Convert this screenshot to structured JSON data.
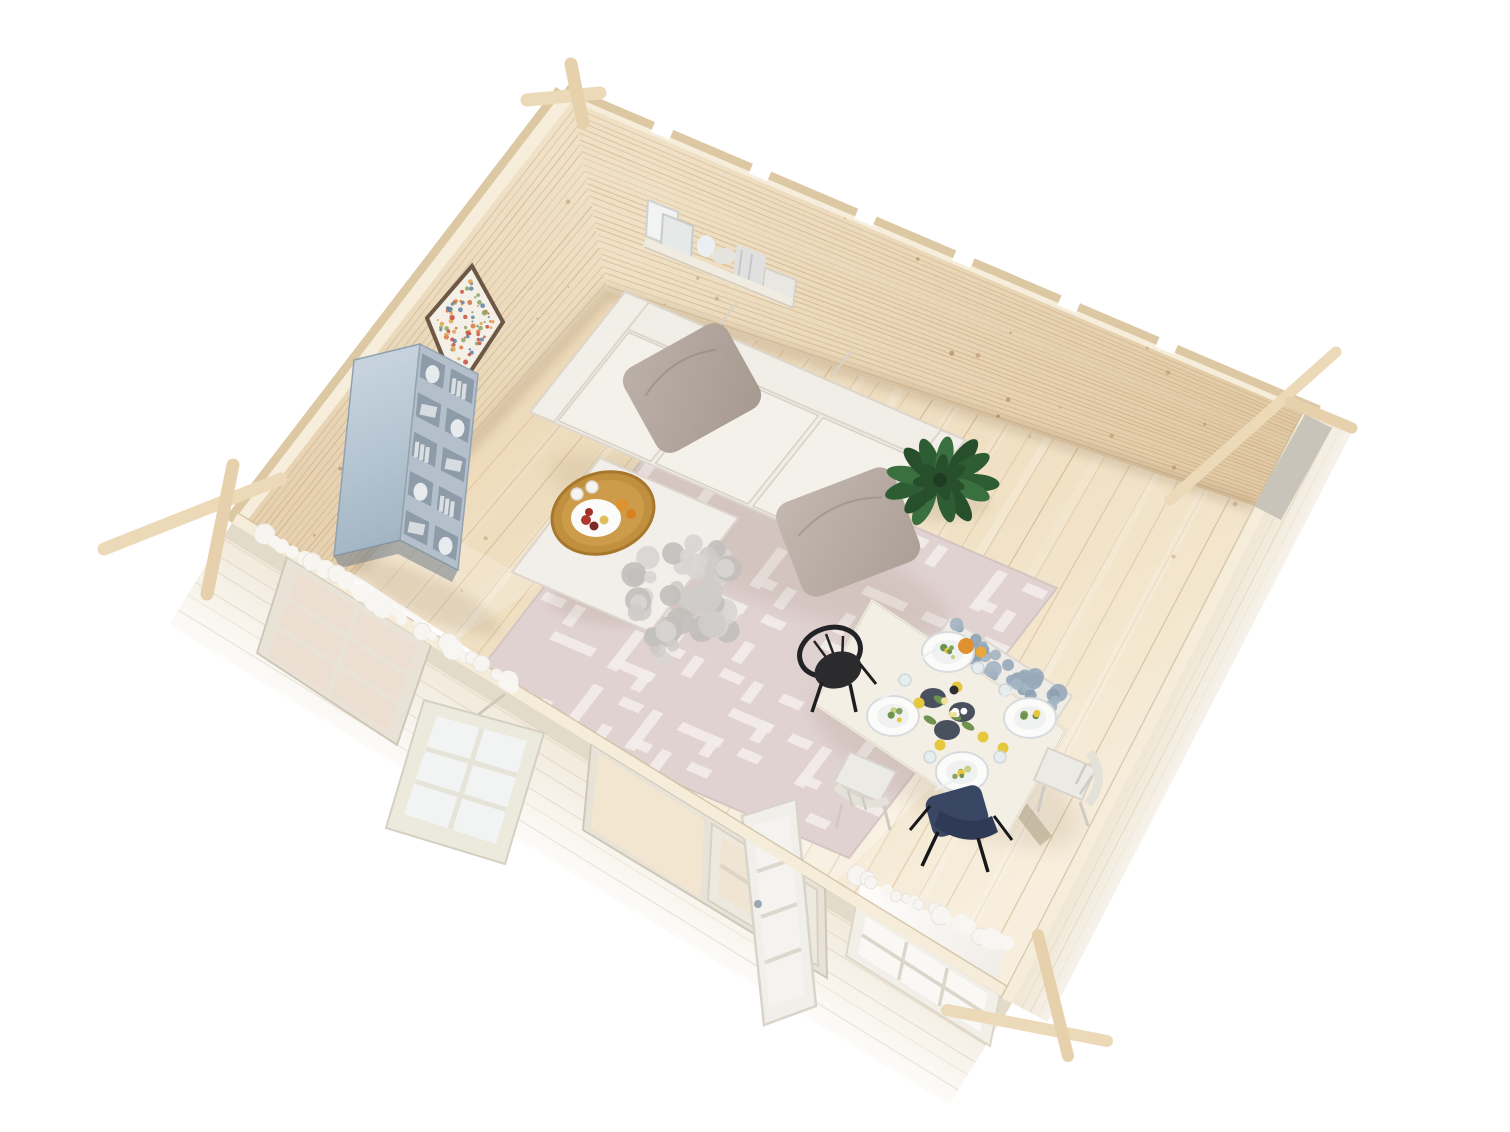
{
  "scene": {
    "description": "Aerial 3D render of a log cabin garden-room interior with lounge and dining furniture, no visible text",
    "background": "#ffffff"
  },
  "colors": {
    "wall_wood_light": "#f0e2c8",
    "wall_wood_shade": "#e2cda9",
    "wall_top": "#f6eedb",
    "wall_outer_edge": "#ddc8a4",
    "floor_light": "#f7eedd",
    "floor_warm": "#ecd9b8",
    "grain_line": "#b98c5c",
    "knot_brown": "#a97f4f",
    "front_wall_face": "#efe7d7",
    "ledge": "#f5ecd9",
    "molding": "#e3dbc9",
    "window_frame": "#e9e3d7",
    "window_glass_warm": "#ecdfd2",
    "window_glass_cool": "#f2f4f3",
    "door_glass": "#efe5d2",
    "doorway_interior": "#f2e6d1",
    "grid_bar": "#dcd6ca",
    "curtain_white": "#f9f8f5",
    "garland_white": "#f8f6f2",
    "rug_base": "#e0d2d1",
    "rug_pattern": "#f2ebea",
    "sofa_body": "#f0ece6",
    "sofa_cushion": "#f4f0ea",
    "sofa_seam": "#d9d2c8",
    "pillow_taupe": "#b3a79f",
    "pillow_taupe_dark": "#a5988f",
    "ottoman": "#f2eee9",
    "fur_tones": [
      "#cfccc9",
      "#c2bfbc",
      "#d8d5d2"
    ],
    "tray_gold": "#c0903f",
    "tray_rim": "#a6772d",
    "plate_white": "#fbfbfa",
    "plate_dark": "#49505e",
    "lemon_yellow": "#e5c83e",
    "orange_fruit": "#e0912f",
    "berry_red": "#b0392f",
    "plant_tones": [
      "#2f5d33",
      "#3a7040",
      "#274f2c"
    ],
    "plant_center": "#1f3d24",
    "bookshelf_top": "#c6d3de",
    "bookshelf_frame": "#b3c0cb",
    "bookshelf_cell": "#8c99a5",
    "shelf_object_white": "#eceff1",
    "wall_shelf_board": "#f0ece2",
    "art_frame": "#6d5846",
    "art_paper": "#f4f0e7",
    "art_speckles": [
      "#dd7340",
      "#c44f3f",
      "#8aa45f",
      "#5d82a6",
      "#e0a34c"
    ],
    "table_top": "#f4efe5",
    "table_edge": "#ddd3c0",
    "chair_black": "#2b2b2e",
    "chair_white": "#eceae4",
    "chair_navy": "#394664",
    "chair_navy_dark": "#2f3a57",
    "bench_white": "#efece6",
    "bench_tones": [
      "#8da1b3",
      "#a3b4c2",
      "#97a9ba"
    ],
    "glass_cup": "#e6edf0",
    "greenery": "#6f934f",
    "corner_log": "#ecd9b8",
    "corner_log_edge": "#d8c09a",
    "shadow": "#6e5539"
  },
  "objects": {
    "back_left_wall": "log-wall",
    "back_right_wall": "log-wall",
    "front_left_wall": "low log-wall with window and doors",
    "front_right_wall": "low log-wall",
    "floor": "pine plank floor",
    "area_rug": "patterned rug",
    "sofa": "three-seat sofa",
    "ottoman": "ottoman coffee table",
    "serving_tray": "gold tray with fruit",
    "fur_throw": "grey fur throw",
    "potted_plant": "green plant",
    "bookshelf": "grey-blue shelving unit",
    "wall_art": "framed speckled print",
    "wall_shelf": "wall shelf with books and vases",
    "dining_table": "set dining table",
    "dining_bench": "bench with grey cushion",
    "chair_black": "black spindle chair",
    "chair_white_left": "white chair",
    "chair_white_right": "white chair",
    "chair_white_head": "white chair",
    "chair_navy": "navy chair",
    "window_fixed": "glazed window",
    "window_open": "open casement window",
    "door_double": "glazed double door",
    "door_open_leaf": "open door leaf",
    "window_curtained": "window with sheer curtain",
    "garland": "white fluffy garland",
    "corner_logs": "interlocking log corner joints"
  }
}
